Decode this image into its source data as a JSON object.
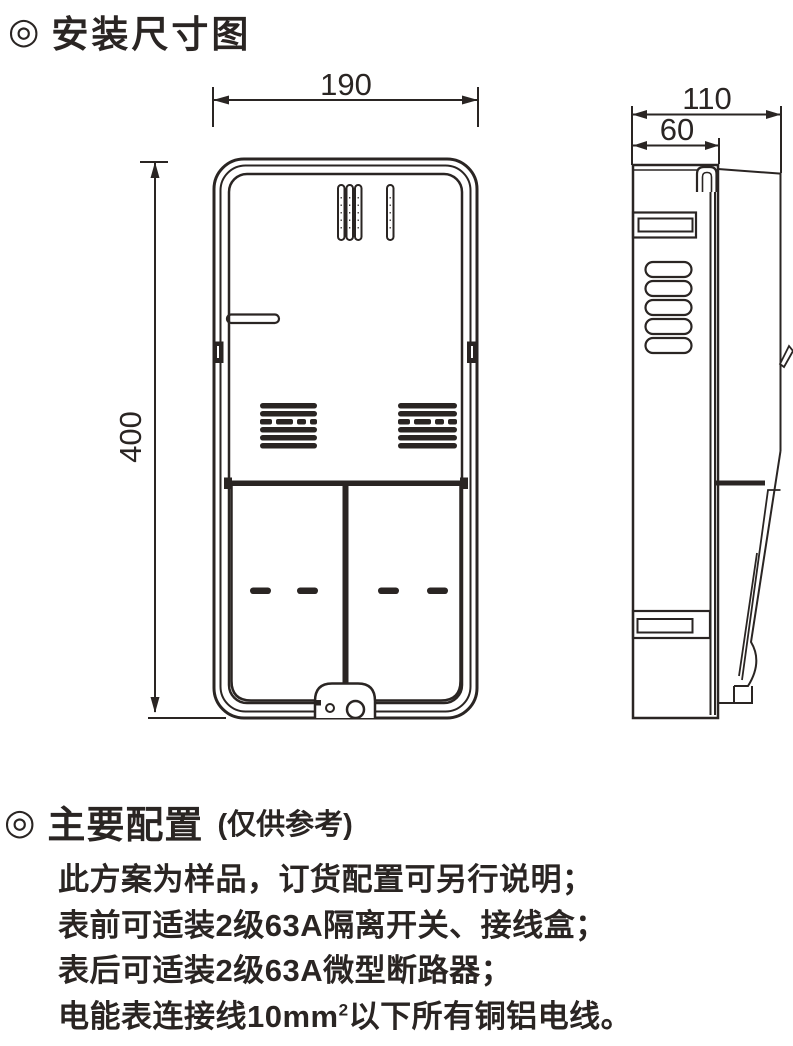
{
  "colors": {
    "ink": "#2a2523",
    "background": "#ffffff"
  },
  "header": {
    "bullet": "◎",
    "title": "安装尺寸图"
  },
  "diagram": {
    "front_view": {
      "width_dim": "190",
      "height_dim": "400"
    },
    "side_view": {
      "overall_depth_dim": "110",
      "body_depth_dim": "60"
    }
  },
  "config": {
    "bullet": "◎",
    "heading": "主要配置",
    "heading_note": "(仅供参考)",
    "lines": [
      "此方案为样品，订货配置可另行说明；",
      "表前可适装2级63A隔离开关、接线盒；",
      "表后可适装2级63A微型断路器；"
    ],
    "wire_line": {
      "prefix": "电能表连接线10mm",
      "superscript": "2",
      "suffix": "以下所有铜铝电线。"
    }
  }
}
